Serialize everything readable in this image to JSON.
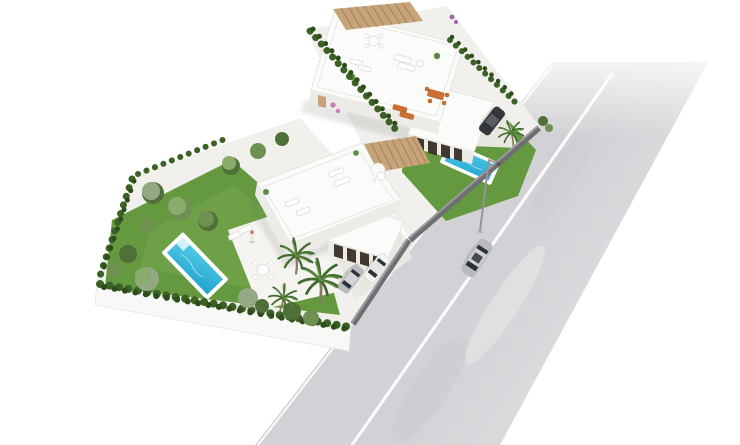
{
  "scene": {
    "type": "3d-architectural-render",
    "view": "aerial-axonometric",
    "description": "Aerial 3D render of two modern white villas on landscaped plots beside a diagonal asphalt road, on a plain white background. Each villa has a flat rooftop terrace with a wooden pergola and sun loungers, a turquoise swimming pool set in a green lawn, cypress hedge boundaries, palm trees, patio furniture and parked cars. A silver sedan drives on the road past a street lamp.",
    "text_content": "none - image contains no visible text",
    "objects": [
      "upper villa with rooftop pergola terrace, patio with orange furniture, pool, lawn, dark parked car, grey boundary wall",
      "lower villa with rooftop pergola terrace, pool with steps, lawn, patio with loungers and dining table, person, silver and white parked cars",
      "cypress hedge rows along plot boundaries",
      "palm trees and olive trees in gardens",
      "diagonal road with white center line fading into white background",
      "silver sedan driving on road",
      "street lamp between plots and road",
      "white platform base under plots"
    ],
    "counts": {
      "villas": 2,
      "pools": 2,
      "parked_cars": 3,
      "moving_cars": 1,
      "people": 1,
      "street_lamps": 1
    }
  },
  "colors": {
    "bg": "#ffffff",
    "road": "#d2d2d6",
    "road_line": "#ffffff",
    "land": "#f1f0ec",
    "platform": "#f8f8f6",
    "paving": "#f5f4f0",
    "paving2": "#e9e7e2",
    "lawn": "#64993f",
    "lawn_light": "#79aa52",
    "pool_rim": "#ffffff",
    "pool_light": "#55cdea",
    "pool_deep": "#22a3cd",
    "roof": "#fbfbf9",
    "roof_edge": "#e2e0dc",
    "face": "#edebe6",
    "glass": "#41382f",
    "pergola": "#c7a37a",
    "pergola_dark": "#a8855c",
    "hedge": "#3c6125",
    "hedge_dark": "#2e4d1b",
    "tree": "#6e9152",
    "tree_dark": "#4f7038",
    "tree_light": "#8aac6c",
    "olive": "#93a883",
    "palm": "#3f6a2c",
    "palm_light": "#5f8d43",
    "trunk": "#8a795c",
    "wall": "#6e6e73",
    "wall_top": "#9b9ba0",
    "car_dark": "#34373c",
    "car_silver": "#b7babe",
    "car_white": "#f3f3f2",
    "window": "#2e3338",
    "furniture_orange": "#cf6f2e",
    "furniture_white": "#ffffff",
    "furniture_stroke": "#d9d7d2",
    "plant": "#5c8a46",
    "skin": "#bd8060",
    "flower_purple": "#a963a9",
    "flower_pink": "#c77fb5",
    "lamp": "#94949a"
  }
}
